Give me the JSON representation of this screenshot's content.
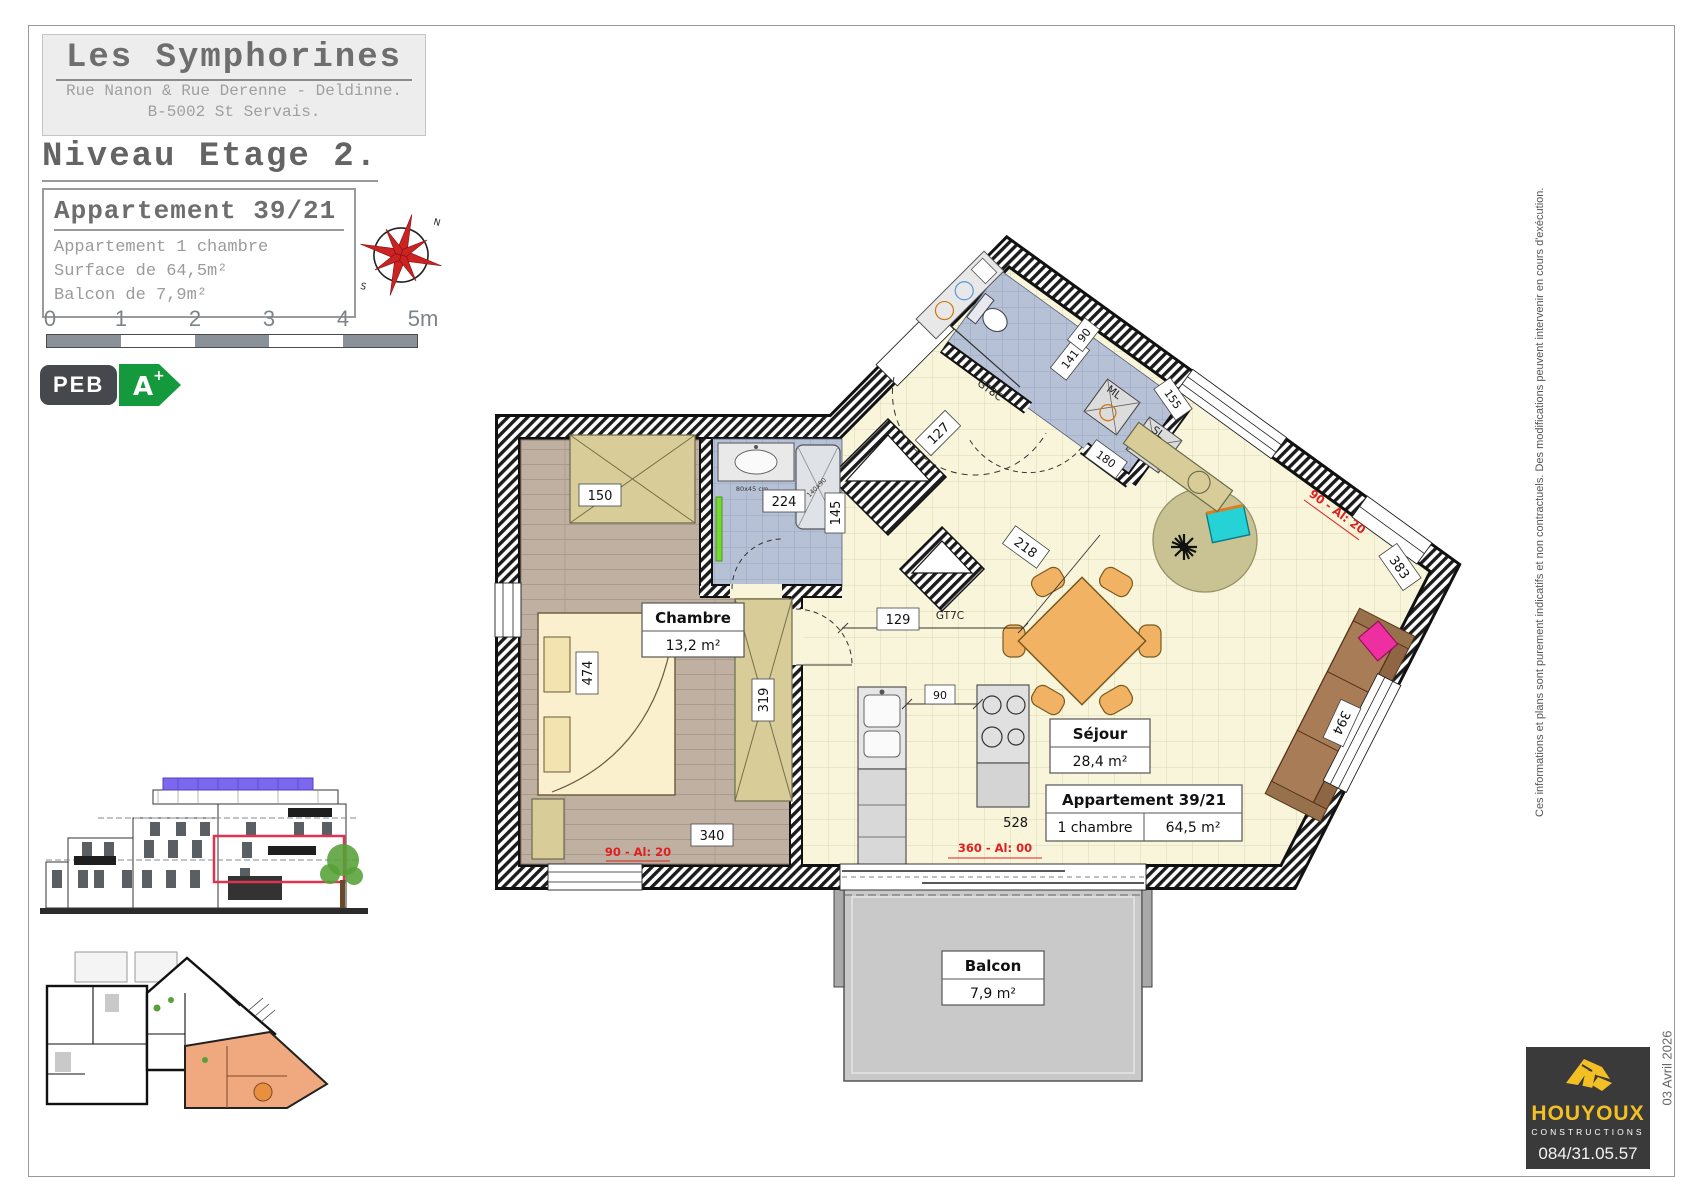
{
  "header": {
    "project": "Les Symphorines",
    "address1": "Rue Nanon & Rue Derenne - Deldinne.",
    "address2": "B-5002 St Servais.",
    "level": "Niveau Etage 2."
  },
  "apartment_card": {
    "title": "Appartement 39/21",
    "line1": "Appartement 1 chambre",
    "line2": "Surface de 64,5m²",
    "line3": "Balcon de 7,9m²"
  },
  "scalebar": {
    "t0": "0",
    "t1": "1",
    "t2": "2",
    "t3": "3",
    "t4": "4",
    "t5": "5m"
  },
  "peb": {
    "label": "PEB",
    "grade": "A",
    "plus": "+",
    "green": "#149a3c"
  },
  "compass": {
    "n": "N",
    "s": "S"
  },
  "plan": {
    "rooms": {
      "chambre": {
        "name": "Chambre",
        "area": "13,2 m²"
      },
      "sejour": {
        "name": "Séjour",
        "area": "28,4 m²"
      },
      "balcon": {
        "name": "Balcon",
        "area": "7,9 m²"
      }
    },
    "apt_box": {
      "title": "Appartement 39/21",
      "rooms": "1 chambre",
      "area": "64,5 m²"
    },
    "dims": {
      "d150": "150",
      "d224": "224",
      "d145": "145",
      "d474": "474",
      "d319": "319",
      "d340": "340",
      "d528": "528",
      "d127": "127",
      "d129": "129",
      "d90": "90",
      "d218": "218",
      "d141": "141",
      "d90wc": "90",
      "d180": "180",
      "d155": "155",
      "d383": "383",
      "d394": "394"
    },
    "codes": {
      "gt8c": "GT8C",
      "gt7c": "GT7C",
      "ml": "ML",
      "sl": "SL",
      "shower": "140x90",
      "vanity": "80x45 cm"
    },
    "red": {
      "win_bedroom": "90 - Al: 20",
      "win_sejour": "360 - Al: 00",
      "win_top": "90 - Al: 20"
    }
  },
  "margin": {
    "disclaimer": "Ces informations et plans sont purement indicatifs et non contractuels.  Des modifications peuvent intervenir en cours d'exécution.",
    "date": "03 Avril 2026"
  },
  "logo": {
    "brand": "HOUYOUX",
    "sub": "CONSTRUCTIONS",
    "phone": "084/31.05.57"
  }
}
